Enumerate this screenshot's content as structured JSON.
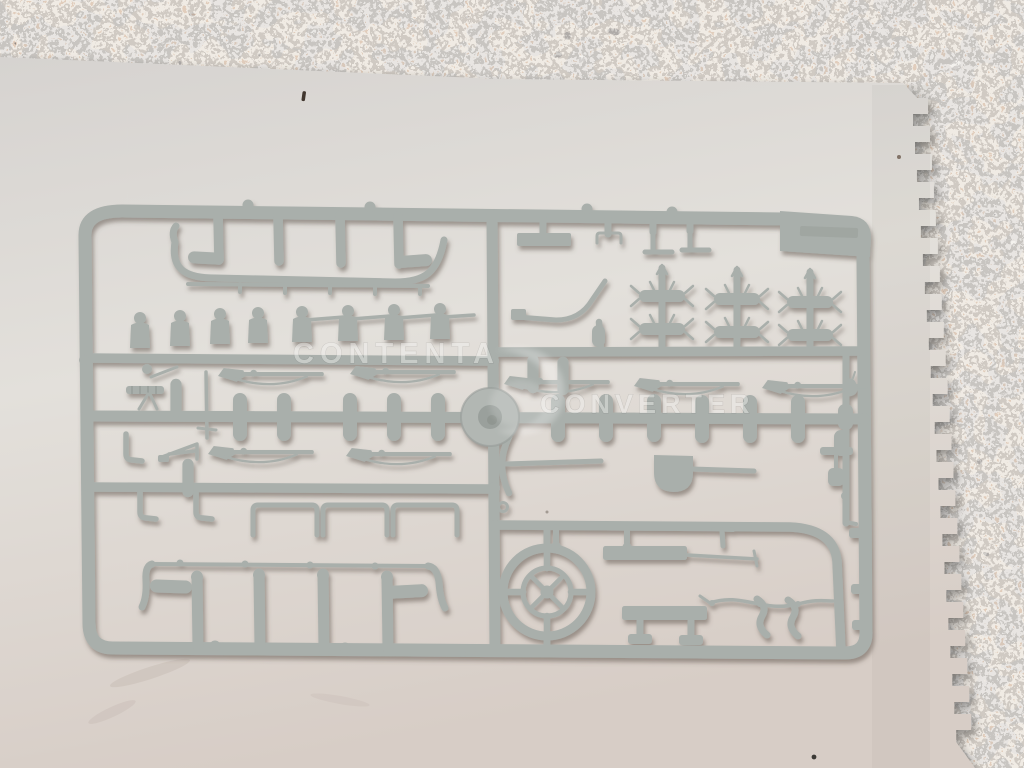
{
  "scene": {
    "type": "photograph",
    "subject": "Grey plastic model-kit sprue with small military accessory parts lying on a white sheet of paper on a granite countertop",
    "colors": {
      "granite_dark": "#262522",
      "granite_tan": "#bd9377",
      "granite_light": "#e9e7e3",
      "paper": "#dedad5",
      "plastic": "#a9afab",
      "plastic_dark": "#878d89",
      "shadow": "#6f6258",
      "watermark": "#f4f4f2"
    }
  },
  "watermark": {
    "line1": "CONTENTA",
    "line2": "CONVERTER",
    "logo": "swoosh-logo"
  }
}
